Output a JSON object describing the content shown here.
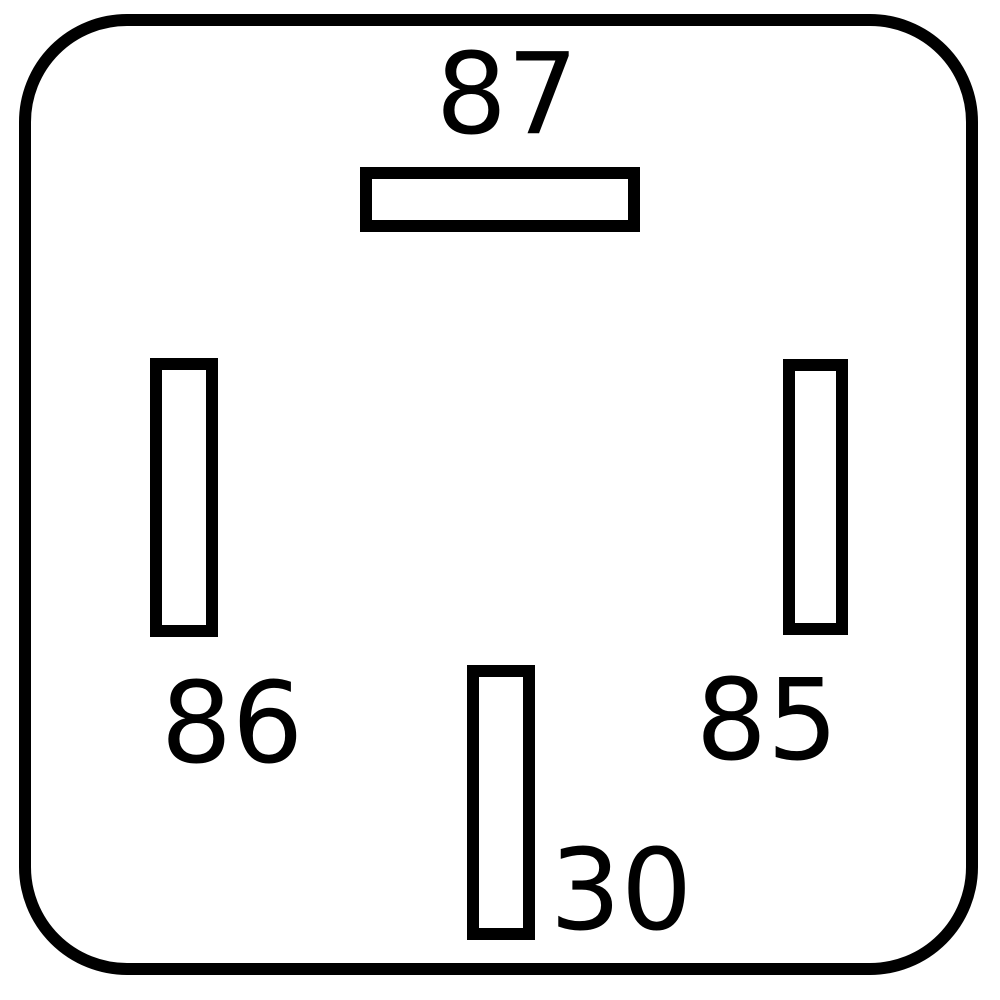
{
  "diagram": {
    "kind": "relay-pin-diagram",
    "pins": [
      {
        "label": "87",
        "position": "top-center",
        "terminal_orientation": "horizontal"
      },
      {
        "label": "86",
        "position": "left",
        "terminal_orientation": "vertical"
      },
      {
        "label": "85",
        "position": "right",
        "terminal_orientation": "vertical"
      },
      {
        "label": "30",
        "position": "bottom-center",
        "terminal_orientation": "vertical"
      }
    ],
    "colors": {
      "line": "#000000",
      "background": "#ffffff"
    }
  }
}
